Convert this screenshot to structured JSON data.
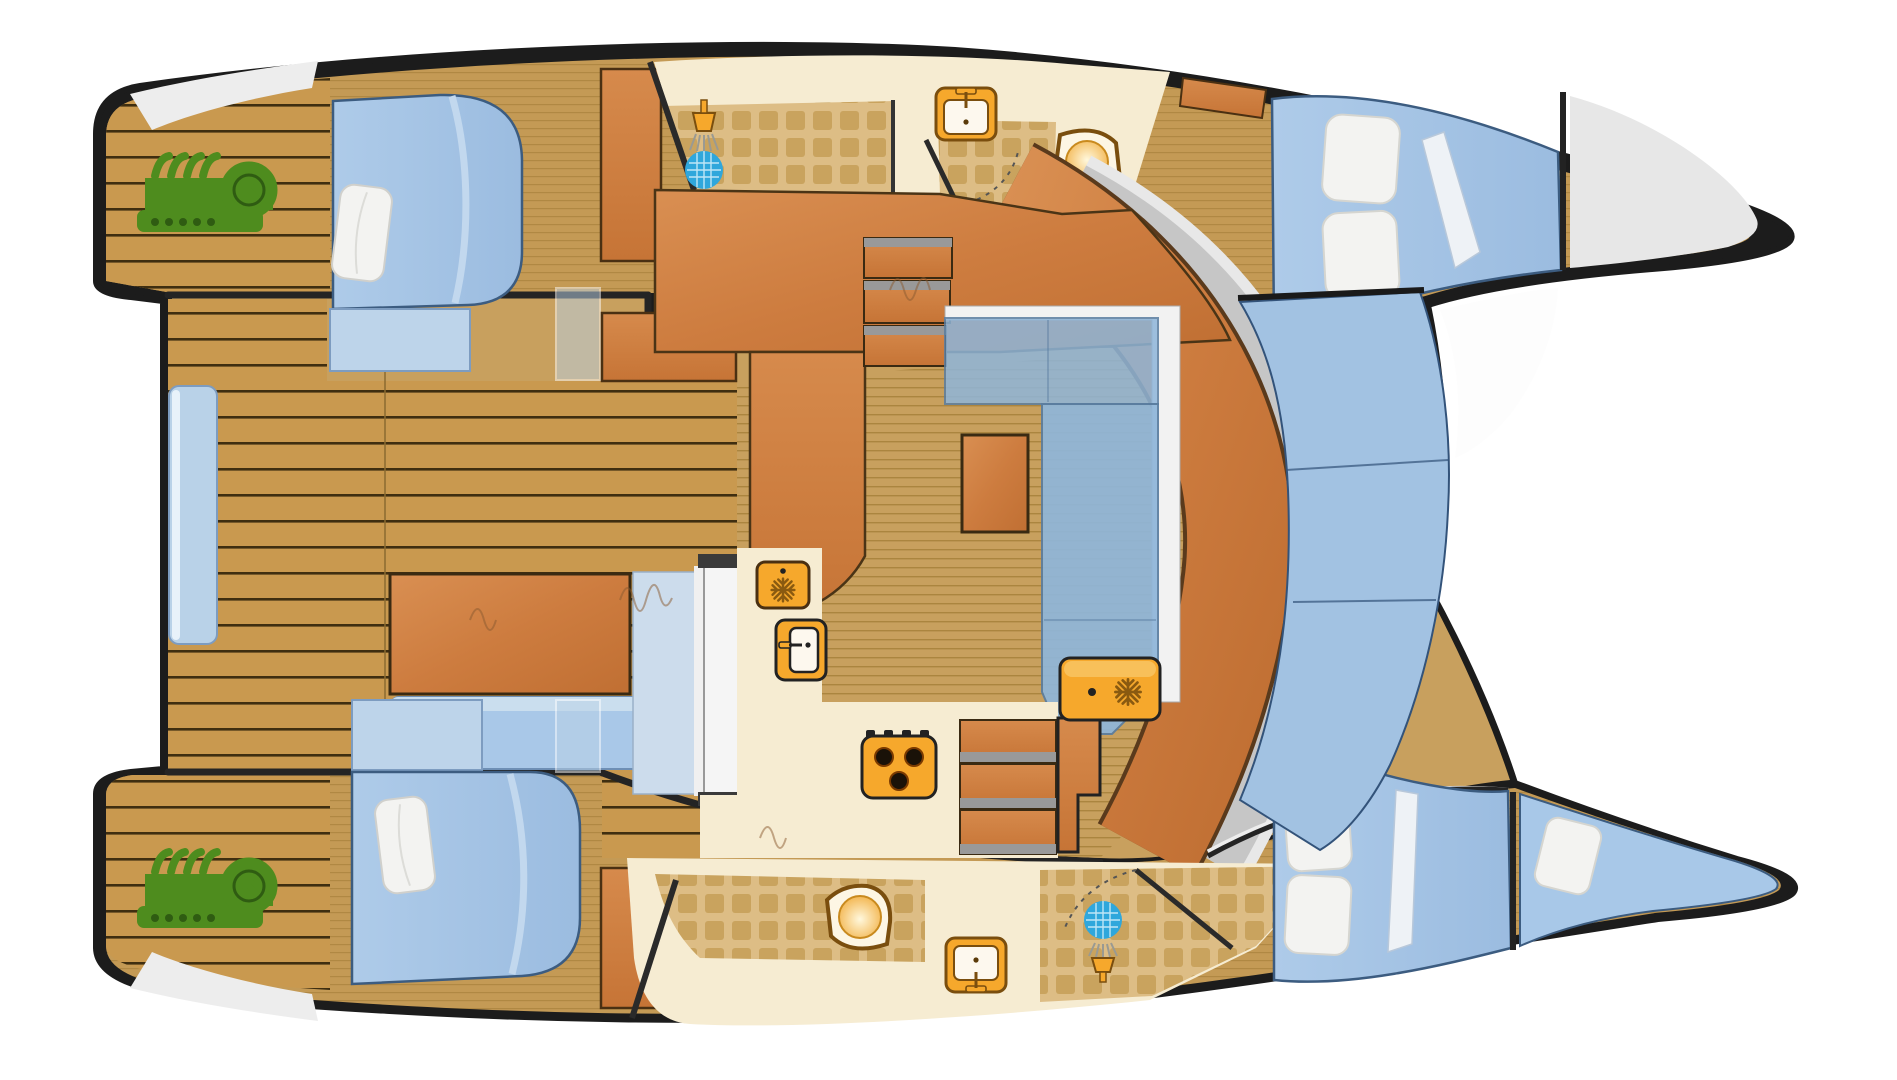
{
  "meta": {
    "title": "Catamaran yacht accommodation floor plan",
    "aria_label": "Top-down floor plan of a catamaran yacht, bow to the right, showing two hulls with cabins and bathrooms, central salon with galley and dinette, aft cockpit with table, and forward cockpit seating",
    "view": "overhead deck plan",
    "orientation": "bow-right"
  },
  "palette": {
    "outline": "#1c1c1c",
    "teak": "#c9994f",
    "sole": "#c8a05e",
    "soleCabin": "#c49a55",
    "cream": "#f6ecd2",
    "tileBase": "#ddbd85",
    "tileSquare": "#c9a35e",
    "wood": "#d08348",
    "woodDark": "#4a3012",
    "bedBlue": "#a3c3e5",
    "bedBlueLight": "#c2d8ee",
    "benchBlue": "#b9d2e8",
    "seatBlue": "#a2c2e2",
    "pillow": "#f3f3f1",
    "orange": "#f6a82c",
    "orangeDark": "#7a4e0e",
    "green": "#4e8c1e",
    "grayBand": "#c6c6c6",
    "bowGray": "#e7e7e7",
    "white": "#f2f2f2",
    "showerBlue": "#2fa7dc"
  },
  "areas": [
    {
      "id": "port-aft-deck",
      "name": "port transom deck with engine hatch"
    },
    {
      "id": "starboard-aft-deck",
      "name": "starboard transom deck with engine hatch"
    },
    {
      "id": "aft-cockpit",
      "name": "aft cockpit with table and benches"
    },
    {
      "id": "port-aft-cabin",
      "name": "port aft double cabin"
    },
    {
      "id": "starboard-aft-cabin",
      "name": "starboard aft double cabin"
    },
    {
      "id": "port-bathroom",
      "name": "port head with shower, sink and toilet"
    },
    {
      "id": "starboard-bathroom",
      "name": "starboard head with shower, sink and toilet"
    },
    {
      "id": "salon",
      "name": "main salon with dinette"
    },
    {
      "id": "galley",
      "name": "galley with fridge, sink and stove"
    },
    {
      "id": "port-bow-cabin",
      "name": "port forward double cabin"
    },
    {
      "id": "starboard-bow-cabin",
      "name": "starboard forward double cabin"
    },
    {
      "id": "forepeak-berth",
      "name": "starboard forepeak berth"
    },
    {
      "id": "bow-locker",
      "name": "port bow sail locker"
    },
    {
      "id": "forward-cockpit",
      "name": "forward cockpit lounge seating"
    }
  ],
  "fixtures": [
    {
      "id": "port-engine",
      "icon": "engine-icon",
      "color": "#4e8c1e"
    },
    {
      "id": "starboard-engine",
      "icon": "engine-icon",
      "color": "#4e8c1e"
    },
    {
      "id": "port-shower",
      "icon": "shower-icon"
    },
    {
      "id": "starboard-shower",
      "icon": "shower-icon"
    },
    {
      "id": "port-bath-sink",
      "icon": "sink-icon"
    },
    {
      "id": "starboard-bath-sink",
      "icon": "sink-icon"
    },
    {
      "id": "port-toilet",
      "icon": "toilet-icon"
    },
    {
      "id": "starboard-toilet",
      "icon": "toilet-icon"
    },
    {
      "id": "galley-fridge",
      "icon": "fridge-snowflake-icon"
    },
    {
      "id": "galley-sink",
      "icon": "sink-icon"
    },
    {
      "id": "galley-stove",
      "icon": "stove-three-burner-icon"
    },
    {
      "id": "freezer",
      "icon": "freezer-snowflake-icon"
    },
    {
      "id": "cockpit-table",
      "icon": "table"
    },
    {
      "id": "salon-table",
      "icon": "table"
    },
    {
      "id": "beds",
      "icon": "berth-with-pillows",
      "count": 5
    }
  ]
}
